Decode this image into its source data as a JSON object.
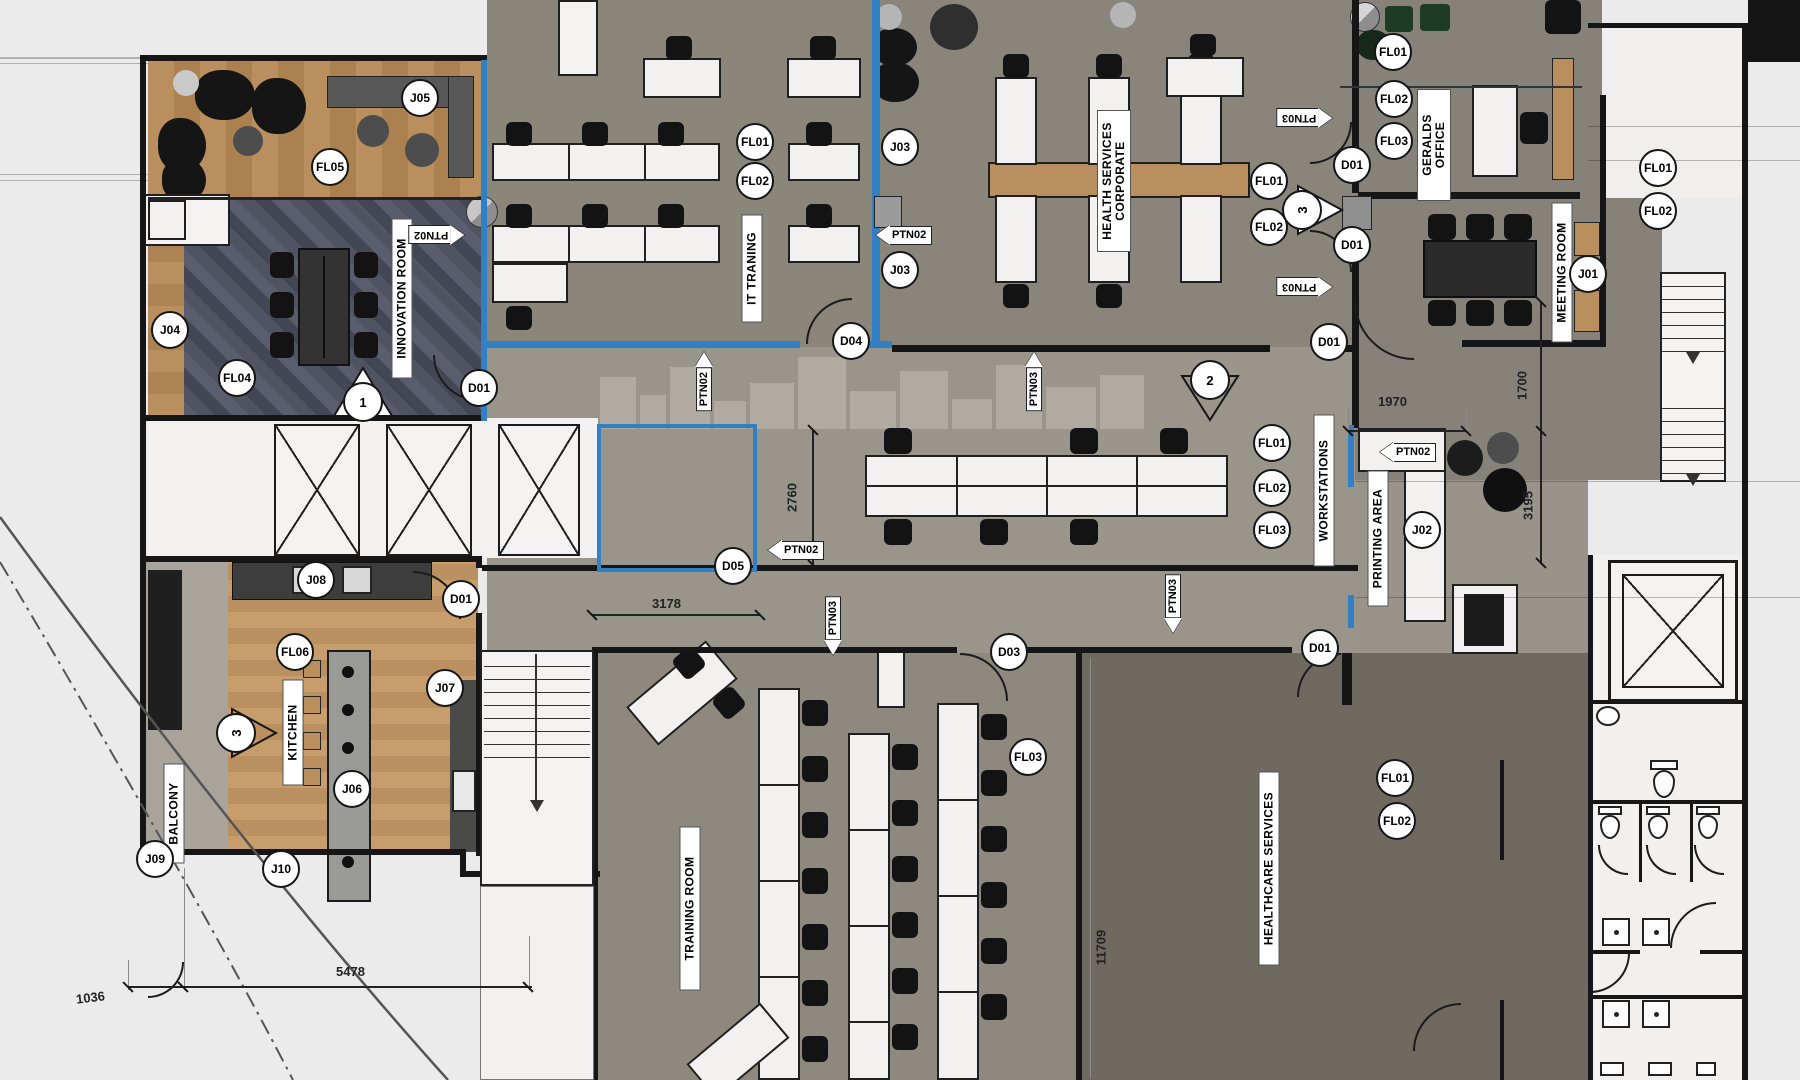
{
  "title": "Office floor plan - furniture and finishes layout",
  "labels": {
    "j01": "J01",
    "j02": "J02",
    "j03": "J03",
    "j04": "J04",
    "j05": "J05",
    "j06": "J06",
    "j07": "J07",
    "j08": "J08",
    "j09": "J09",
    "j10": "J10",
    "fl01": "FL01",
    "fl02": "FL02",
    "fl03": "FL03",
    "fl04": "FL04",
    "fl05": "FL05",
    "fl06": "FL06",
    "d01": "D01",
    "d03": "D03",
    "d04": "D04",
    "d05": "D05",
    "ptn02": "PTN02",
    "ptn03": "PTN03",
    "s1": "1",
    "s2": "2",
    "s3": "3"
  },
  "rooms": {
    "innovation": "INNOVATION ROOM",
    "it_training": "IT TRANING",
    "health_corporate": "HEALTH SERVICES\nCORPORATE",
    "geralds_office": "GERALDS\nOFFICE",
    "meeting": "MEETING ROOM",
    "workstations": "WORKSTATIONS",
    "printing": "PRINTING AREA",
    "kitchen": "KITCHEN",
    "balcony": "BALCONY",
    "training": "TRAINING ROOM",
    "healthcare": "HEALTHCARE SERVICES"
  },
  "dimensions": {
    "d5478": "5478",
    "d1036": "1036",
    "d3178": "3178",
    "d2760": "2760",
    "d1970": "1970",
    "d1700": "1700",
    "d3195": "3195",
    "d11709": "11709"
  },
  "colors": {
    "wall": "#161616",
    "glass_partition_blue": "#2f80c4",
    "wood": "#b98f5e",
    "carpet": "#8a867a",
    "carpet_dark": "#6e6a60",
    "carpet_light": "#99958b",
    "innovation_carpet": "#4e5161"
  }
}
